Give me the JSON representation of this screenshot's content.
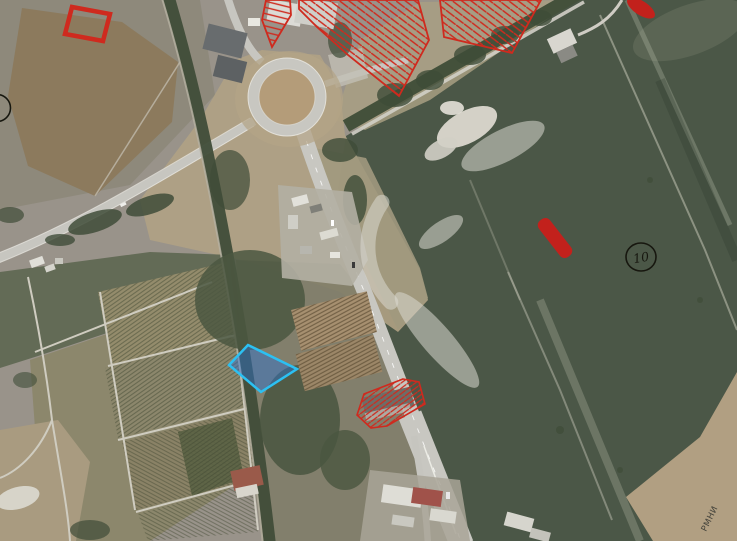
{
  "map": {
    "labels": {
      "parcel_marker": "10",
      "corner_text": "РМНИ"
    },
    "colors": {
      "overlay_red": "#cf2a1e",
      "overlay_red_fill": "#c2211c",
      "selected_parcel_fill": "rgba(45,115,210,0.45)",
      "selected_parcel_stroke": "#2cc0f2",
      "marker_ink": "#17170f",
      "watermark": "rgba(218,217,207,0.55)"
    },
    "features": {
      "selected_parcel": "blue-highlighted-parcel",
      "offer_parcels": "red-hatched-parcels",
      "filled_marks": "red-filled-marks",
      "numbered_marker": "circle-10"
    }
  }
}
